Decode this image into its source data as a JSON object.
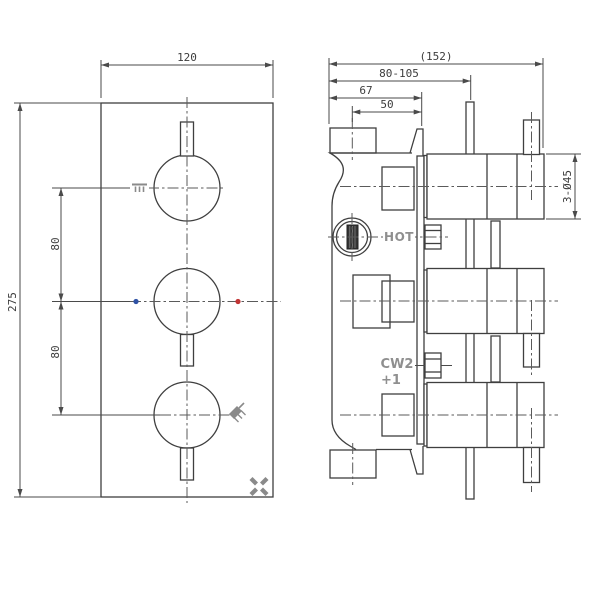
{
  "drawing": {
    "title": "thermostatic-shower-valve-3-control-technical-drawing",
    "front": {
      "dim_width": "120",
      "dim_height": "275",
      "dim_pitch_upper": "80",
      "dim_pitch_lower": "80"
    },
    "side": {
      "dim_overall": "(152)",
      "dim_depth_range": "80-105",
      "dim_body_depth": "67",
      "dim_port_depth": "50",
      "dim_handles": "3-Ø45",
      "label_hot": "HOT",
      "label_cw_line1": "CW2",
      "label_cw_line2": "+1"
    },
    "icons": {
      "upper_function": "bath-spout-icon",
      "lower_function": "shower-head-icon",
      "brand": "crosswater-x-logo"
    },
    "colors": {
      "line": "#3f3f3f",
      "dimension": "#4a4a4a",
      "gray_label": "#8f8f8f",
      "cold_dot": "#2f52a5",
      "hot_dot": "#c23535"
    }
  }
}
